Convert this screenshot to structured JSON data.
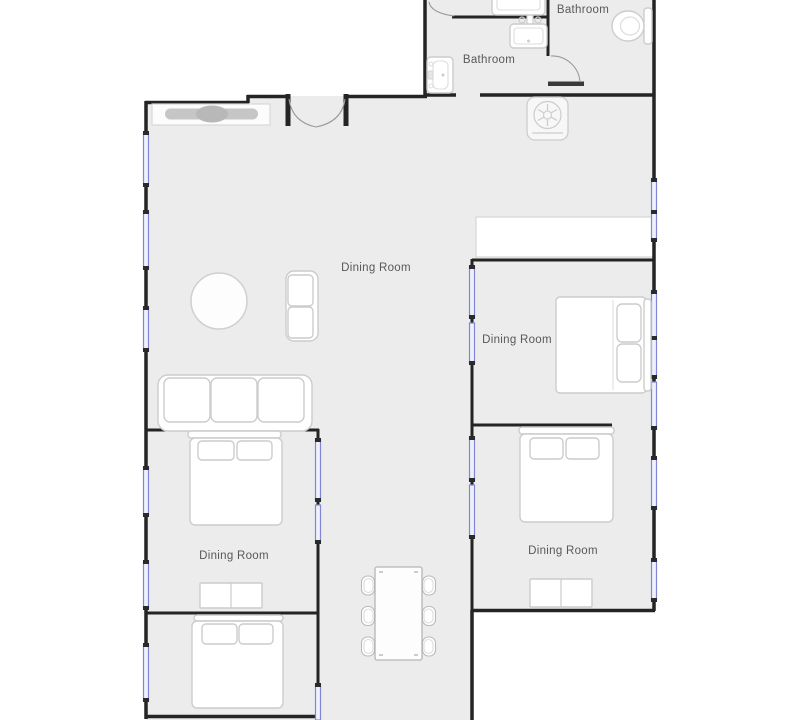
{
  "plan": {
    "rooms": [
      {
        "id": "bathroom-top-left",
        "label": "Bathroom"
      },
      {
        "id": "bathroom-top-right",
        "label": "Bathroom"
      },
      {
        "id": "living-dining-main",
        "label": "Dining Room"
      },
      {
        "id": "bedroom-right",
        "label": "Dining Room"
      },
      {
        "id": "bedroom-bottom-left",
        "label": "Dining Room"
      },
      {
        "id": "bedroom-bottom-right",
        "label": "Dining Room"
      }
    ],
    "furniture": [
      "kitchen-sideboard",
      "round-table",
      "loveseat-sofa",
      "three-seat-sofa",
      "double-bed-right",
      "double-bed-bottom-right",
      "double-bed-left-upper",
      "double-bed-left-lower",
      "dresser-left",
      "dresser-right",
      "dining-table",
      "dining-chair-x6",
      "toilet",
      "wall-sink",
      "vanity-sink",
      "countertop-sink",
      "washing-machine",
      "closet"
    ],
    "colors": {
      "background": "#ffffff",
      "floor": "#ececec",
      "wall": "#242424",
      "window_stroke": "#8285d6",
      "window_fill": "#eef0fa",
      "furniture_outline": "#cccccc",
      "label_text": "#585858"
    }
  }
}
